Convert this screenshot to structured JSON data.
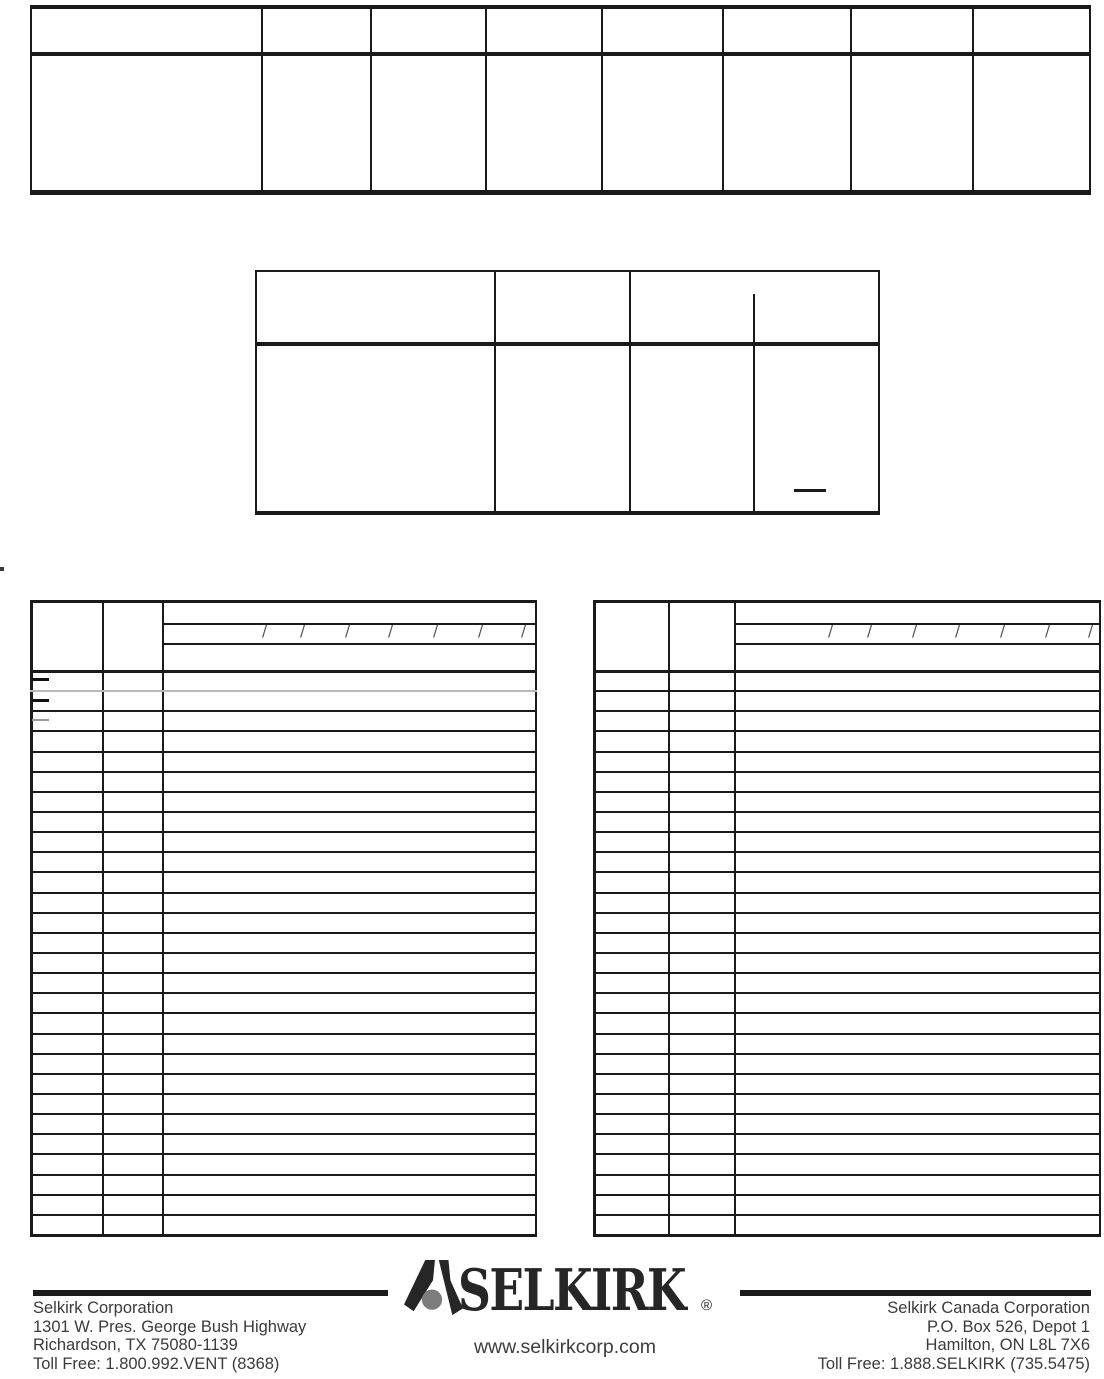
{
  "page": {
    "kind": "scanned-document-page",
    "background": "#ffffff"
  },
  "top_table": {
    "column_count": 8,
    "body_row_count": 1
  },
  "mid_table": {
    "column_count": 3,
    "body_row_count": 1,
    "has_partial_subcolumn": true
  },
  "parts_tables": {
    "slash_glyph": "/",
    "left": {
      "column_count": 3,
      "body_row_count": 28,
      "header_slash_count": 7,
      "dash_mark_count": 3
    },
    "right": {
      "column_count": 3,
      "body_row_count": 28,
      "header_slash_count": 7,
      "dash_mark_count": 0
    }
  },
  "footer": {
    "brand_wordmark": "SELKIRK",
    "registered_mark": "®",
    "website": "www.selkirkcorp.com",
    "us_office": {
      "lines": [
        "Selkirk Corporation",
        "1301 W. Pres. George Bush Highway",
        "Richardson, TX 75080-1139",
        "Toll Free: 1.800.992.VENT (8368)"
      ]
    },
    "canada_office": {
      "lines": [
        "Selkirk Canada Corporation",
        "P.O. Box 526, Depot 1",
        "Hamilton, ON L8L 7X6",
        "Toll Free: 1.888.SELKIRK (735.5475)"
      ]
    },
    "colors": {
      "rule_black": "#1a1a1a",
      "text_gray": "#3b3b3b",
      "logo_black": "#262626",
      "logo_gray": "#7d7d7d"
    }
  }
}
